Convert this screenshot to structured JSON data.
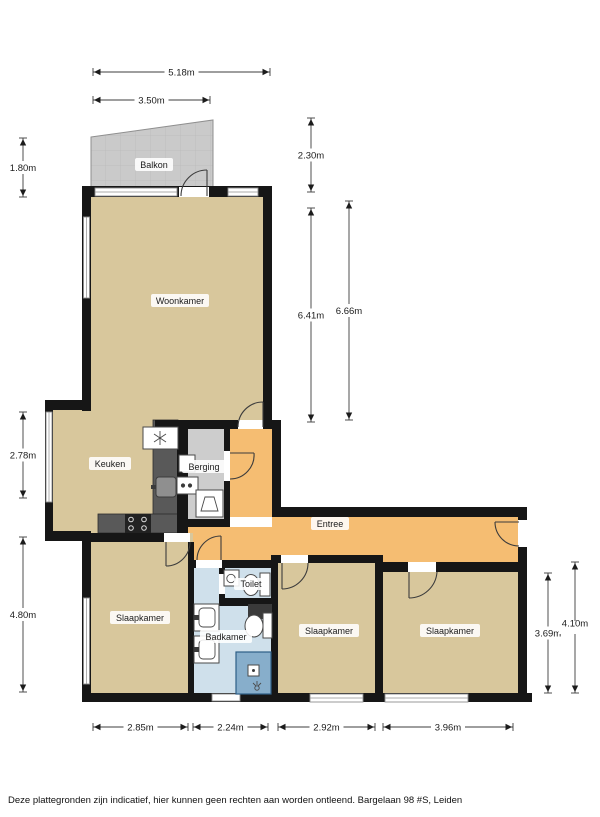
{
  "page": {
    "disclaimer": "Deze plattegronden zijn indicatief, hier kunnen geen rechten aan worden ontleend. Bargelaan 98 #S, Leiden"
  },
  "rooms": {
    "balcony": "Balkon",
    "living": "Woonkamer",
    "kitchen": "Keuken",
    "storage": "Berging",
    "hall": "Entree",
    "toilet": "Toilet",
    "bathroom": "Badkamer",
    "bedroom_left": "Slaapkamer",
    "bedroom_middle": "Slaapkamer",
    "bedroom_right": "Slaapkamer"
  },
  "dimensions": {
    "top_width": "5.18m",
    "balcony_width": "3.50m",
    "balcony_depth_left": "1.80m",
    "balcony_depth_right": "2.30m",
    "living_height_inner": "6.41m",
    "living_height_outer": "6.66m",
    "kitchen_side": "2.78m",
    "bedroom_left_side": "4.80m",
    "bedroom_right_inner": "3.69m",
    "bedroom_right_outer": "4.10m",
    "bedroom_left_width": "2.85m",
    "bathroom_width": "2.24m",
    "bedroom_middle_width": "2.92m",
    "bedroom_right_width": "3.96m"
  },
  "colors": {
    "floor_tan": "#d8c79c",
    "hall_orange": "#f5bd72",
    "bath_blue": "#cfe0eb",
    "shower_blue": "#87aecb",
    "balcony_gray": "#cacaca",
    "storage_gray": "#cdcdcd",
    "wall_black": "#161616",
    "counter_gray": "#595959"
  }
}
